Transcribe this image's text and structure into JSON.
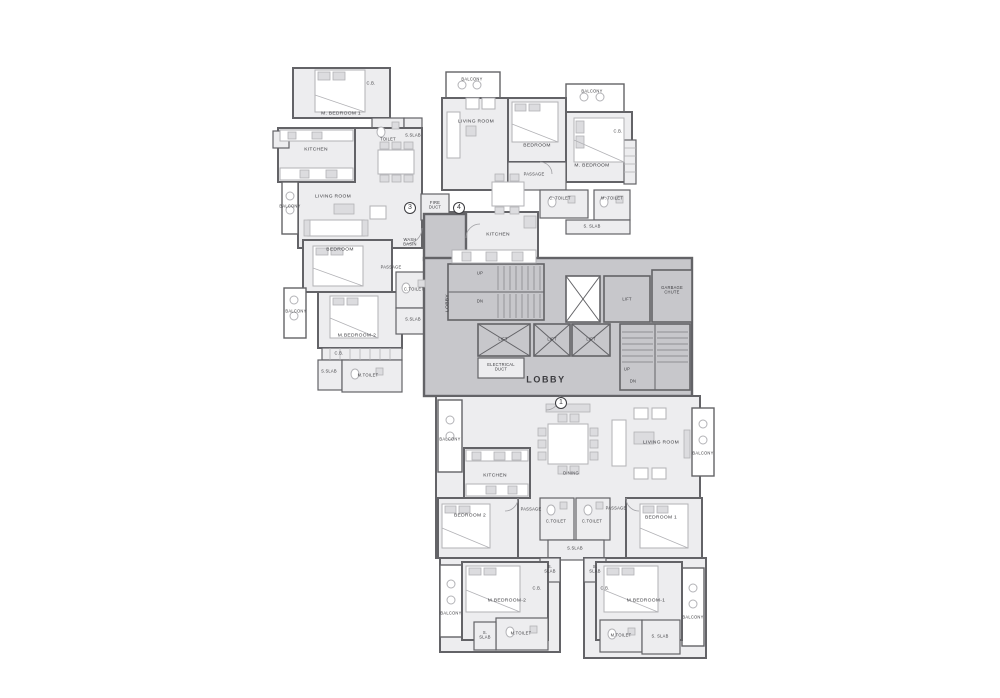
{
  "title": "residential floor plan",
  "colors": {
    "background": "#ffffff",
    "wall": "#636367",
    "room_fill": "#ededef",
    "core_fill": "#c7c7cb",
    "balcony_fill": "#ffffff",
    "furniture": "#b2b2b6",
    "furniture_2": "#dcdcdf",
    "stair_line": "#8f8f93",
    "text": "#3b3b3f"
  },
  "markers": {
    "m1": "1",
    "m3": "3",
    "m4": "4"
  },
  "labels": {
    "tl_m_bedroom_1": "M. BEDROOM 1",
    "tl_cb": "C.B.",
    "tl_toilet": "TOILET",
    "tl_s_slab_1": "S.SLAB",
    "tl_kitchen": "KITCHEN",
    "tl_living_room": "LIVING ROOM",
    "tl_balcony_1": "BALCONY",
    "tl_bedroom": "BEDROOM",
    "tl_m_bedroom_2": "M.BEDROOM-2",
    "tl_cb_2": "C.B.",
    "tl_m_toilet": "M.TOILET",
    "tl_s_slab_2": "S.SLAB",
    "tl_c_toilet": "C.TOILET",
    "tl_s_slab_3": "S.SLAB",
    "tl_passage": "PASSAGE",
    "tl_balcony_2": "BALCONY",
    "tl_wash": "WASH\nBASIN",
    "fire_duct": "FIRE\nDUCT",
    "tr_balcony_1": "BALCONY",
    "tr_living_room": "LIVING ROOM",
    "tr_bedroom": "BEDROOM",
    "tr_balcony_2": "BALCONY",
    "tr_m_bedroom": "M. BEDROOM",
    "tr_cb": "C.B.",
    "tr_passage": "PASSAGE",
    "tr_c_toilet": "C. TOILET",
    "tr_m_toilet": "M. TOILET",
    "tr_s_slab": "S. SLAB",
    "tr_kitchen": "KITCHEN",
    "core_lobby_v": "LOBBY",
    "core_up_1": "UP",
    "core_dn_1": "DN",
    "core_lift_1": "LIFT",
    "core_lift_2": "LIFT",
    "core_lift_3": "LIFT",
    "core_lift_4": "LIFT",
    "core_elec": "ELECTRICAL\nDUCT",
    "core_lobby": "LOBBY",
    "core_garbage": "GARBAGE\nCHUTE",
    "core_up_2": "UP",
    "core_dn_2": "DN",
    "b_balcony_1": "BALCONY",
    "b_kitchen": "KITCHEN",
    "b_dining": "DINING",
    "b_living_room": "LIVING ROOM",
    "b_balcony_2": "BALCONY",
    "b_passage_1": "PASSAGE",
    "b_passage_2": "PASSAGE",
    "b_c_toilet_1": "C.TOILET",
    "b_c_toilet_2": "C.TOILET",
    "b_s_slab_c": "S.SLAB",
    "b_bedroom_2": "BEDROOM 2",
    "b_bedroom_1": "BEDROOM 1",
    "b_s_slab_l": "S.\nSLAB",
    "b_s_slab_r": "S.\nSLAB",
    "b_m_bedroom_2": "M.BEDROOM-2",
    "b_cb_1": "C.B.",
    "b_m_toilet_1": "M.TOILET",
    "b_s_slab_1": "S.\nSLAB",
    "b_balcony_3": "BALCONY",
    "b_m_bedroom_1": "M.BEDROOM-1",
    "b_cb_2": "C.B.",
    "b_m_toilet_2": "M.TOILET",
    "b_s_slab_2": "S. SLAB",
    "b_balcony_4": "BALCONY"
  }
}
